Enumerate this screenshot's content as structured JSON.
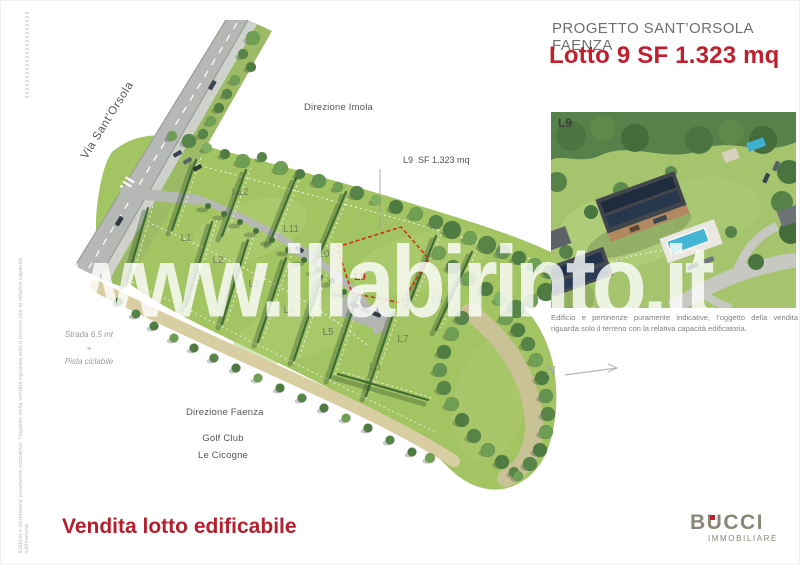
{
  "header": {
    "project_title": "PROGETTO SANT’ORSOLA FAENZA",
    "lot_headline": "Lotto 9 SF 1.323 mq"
  },
  "map": {
    "street_label": "Via Sant’Orsola",
    "direction_north_label": "Direzione Imola",
    "direction_south_label": "Direzione Faenza",
    "poi_line1": "Golf Club",
    "poi_line2": "Le Cicogne",
    "road_note": {
      "line1": "Strada 6,5 mt",
      "line2": "+",
      "line3": "Pista ciclabile"
    },
    "callout_label": "L9  SF 1.323 mq",
    "highlighted_lot": "L9",
    "lots": [
      {
        "id": "L1",
        "x": 186,
        "y": 241
      },
      {
        "id": "L2",
        "x": 218,
        "y": 263
      },
      {
        "id": "L3",
        "x": 254,
        "y": 287
      },
      {
        "id": "L4",
        "x": 289,
        "y": 313
      },
      {
        "id": "L5",
        "x": 328,
        "y": 335
      },
      {
        "id": "L6",
        "x": 375,
        "y": 370
      },
      {
        "id": "L7",
        "x": 403,
        "y": 342
      },
      {
        "id": "L8",
        "x": 437,
        "y": 303
      },
      {
        "id": "L9",
        "x": 360,
        "y": 280,
        "highlight": true
      },
      {
        "id": "L10",
        "x": 321,
        "y": 257
      },
      {
        "id": "L11",
        "x": 291,
        "y": 232
      },
      {
        "id": "L12",
        "x": 240,
        "y": 195
      }
    ]
  },
  "inset": {
    "tag": "L9",
    "caption": "Edificio e pertinenze puramente indicative, l’oggetto della vendita riguarda solo il terreno con la relativa capacità edificatoria."
  },
  "compass": {
    "label": "N"
  },
  "watermark": "www.illabirinto.it",
  "footer": {
    "sale_label": "Vendita lotto edificabile",
    "agency": {
      "name": "BUCCI",
      "subtitle": "IMMOBILIARE"
    }
  },
  "side_note": "Edificio e pertinenze puramente indicative, l’oggetto della vendita riguarda solo il terreno con la relativa capacità edificatoria",
  "colors": {
    "accent_red": "#c0202e",
    "text_gray": "#6e6f71",
    "map_green": "#a3c463",
    "logo_taupe": "#8c8678"
  }
}
